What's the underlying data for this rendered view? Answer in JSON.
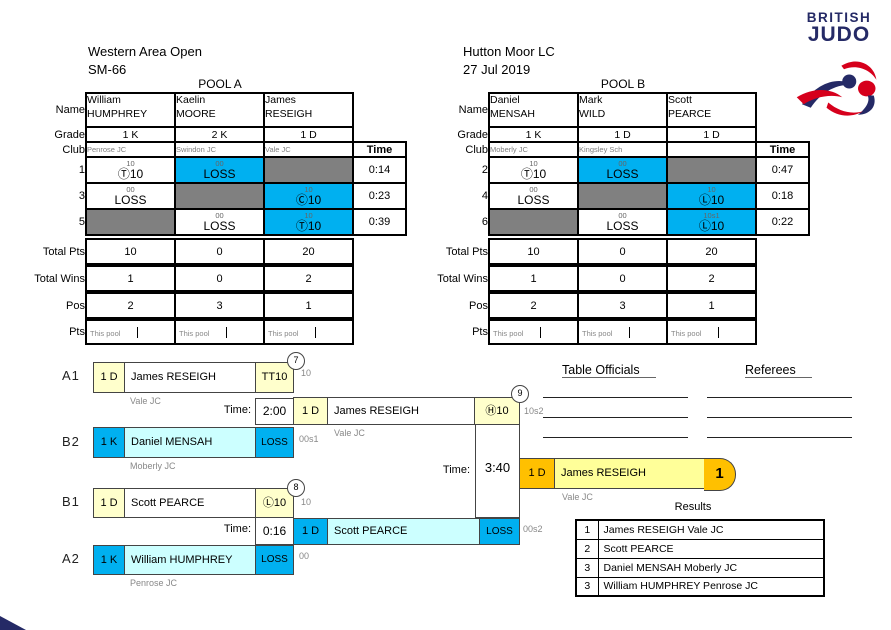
{
  "event": {
    "title": "Western Area Open",
    "category": "SM-66",
    "venue": "Hutton Moor LC",
    "date": "27 Jul 2019"
  },
  "labels": {
    "name": "Name",
    "grade": "Grade",
    "club": "Club",
    "time": "Time",
    "total_pts": "Total Pts",
    "total_wins": "Total Wins",
    "pos": "Pos",
    "pts": "Pts",
    "this_pool": "This pool",
    "time_prefix": "Time:"
  },
  "pools": [
    {
      "title": "POOL A",
      "players": [
        {
          "first": "William",
          "last": "HUMPHREY",
          "grade": "1 K",
          "club": "Penrose JC",
          "total_pts": "10",
          "total_wins": "1",
          "pos": "2"
        },
        {
          "first": "Kaelin",
          "last": "MOORE",
          "grade": "2 K",
          "club": "Swindon JC",
          "total_pts": "0",
          "total_wins": "0",
          "pos": "3"
        },
        {
          "first": "James",
          "last": "RESEIGH",
          "grade": "1 D",
          "club": "Vale JC",
          "total_pts": "20",
          "total_wins": "2",
          "pos": "1"
        }
      ],
      "matches": [
        {
          "no": "1",
          "time": "0:14",
          "cells": [
            {
              "sup": "10",
              "main": "Ⓣ10"
            },
            {
              "sup": "00",
              "main": "LOSS"
            },
            {}
          ]
        },
        {
          "no": "3",
          "time": "0:23",
          "cells": [
            {
              "sup": "00",
              "main": "LOSS"
            },
            {},
            {
              "sup": "10",
              "main": "Ⓒ10"
            }
          ]
        },
        {
          "no": "5",
          "time": "0:39",
          "cells": [
            {},
            {
              "sup": "00",
              "main": "LOSS"
            },
            {
              "sup": "10",
              "main": "Ⓣ10"
            }
          ]
        }
      ]
    },
    {
      "title": "POOL B",
      "players": [
        {
          "first": "Daniel",
          "last": "MENSAH",
          "grade": "1 K",
          "club": "Moberly JC",
          "total_pts": "10",
          "total_wins": "1",
          "pos": "2"
        },
        {
          "first": "Mark",
          "last": "WILD",
          "grade": "1 D",
          "club": "Kingsley Sch",
          "total_pts": "0",
          "total_wins": "0",
          "pos": "3"
        },
        {
          "first": "Scott",
          "last": "PEARCE",
          "grade": "1 D",
          "club": "",
          "total_pts": "20",
          "total_wins": "2",
          "pos": "1"
        }
      ],
      "matches": [
        {
          "no": "2",
          "time": "0:47",
          "cells": [
            {
              "sup": "10",
              "main": "Ⓣ10"
            },
            {
              "sup": "00",
              "main": "LOSS"
            },
            {}
          ]
        },
        {
          "no": "4",
          "time": "0:18",
          "cells": [
            {
              "sup": "00",
              "main": "LOSS"
            },
            {},
            {
              "sup": "10",
              "main": "Ⓛ10"
            }
          ]
        },
        {
          "no": "6",
          "time": "0:22",
          "cells": [
            {},
            {
              "sup": "00",
              "main": "LOSS"
            },
            {
              "sup": "10s1",
              "main": "Ⓛ10"
            }
          ]
        }
      ]
    }
  ],
  "bracket": {
    "sf1": {
      "slot_top": "A1",
      "slot_bottom": "B2",
      "match_no": "7",
      "time": "2:00",
      "top": {
        "grade": "1 D",
        "name": "James RESEIGH",
        "club": "Vale JC",
        "result": "TT10",
        "annot": "10"
      },
      "bottom": {
        "grade": "1 K",
        "name": "Daniel MENSAH",
        "club": "Moberly JC",
        "result": "LOSS",
        "annot": "00s1"
      }
    },
    "sf2": {
      "slot_top": "B1",
      "slot_bottom": "A2",
      "match_no": "8",
      "time": "0:16",
      "top": {
        "grade": "1 D",
        "name": "Scott PEARCE",
        "club": "",
        "result": "Ⓛ10",
        "annot": "10"
      },
      "bottom": {
        "grade": "1 K",
        "name": "William HUMPHREY",
        "club": "Penrose JC",
        "result": "LOSS",
        "annot": "00"
      }
    },
    "final": {
      "match_no": "9",
      "time": "3:40",
      "top": {
        "grade": "1 D",
        "name": "James RESEIGH",
        "club": "Vale JC",
        "result": "Ⓗ10",
        "annot": "10s2"
      },
      "bottom": {
        "grade": "1 D",
        "name": "Scott PEARCE",
        "result": "LOSS",
        "annot": "00s2"
      },
      "winner": {
        "grade": "1 D",
        "name": "James RESEIGH",
        "club": "Vale JC",
        "place": "1"
      }
    }
  },
  "officials": {
    "left_title": "Table Officials",
    "right_title": "Referees"
  },
  "results": {
    "title": "Results",
    "rows": [
      {
        "pos": "1",
        "name": "James RESEIGH Vale JC"
      },
      {
        "pos": "2",
        "name": "Scott PEARCE"
      },
      {
        "pos": "3",
        "name": "Daniel MENSAH Moberly JC"
      },
      {
        "pos": "3",
        "name": "William HUMPHREY Penrose JC"
      }
    ]
  },
  "logo": {
    "top": "BRITISH",
    "bottom": "JUDO"
  },
  "colors": {
    "cyan": "#00B0F0",
    "pale_cyan": "#CCFFFF",
    "pale_yellow": "#FFFFCC",
    "gold": "#FFC000",
    "winner_yellow": "#FFFF99",
    "gray_cell": "#808080",
    "navy": "#252A66",
    "red": "#D6001C"
  }
}
